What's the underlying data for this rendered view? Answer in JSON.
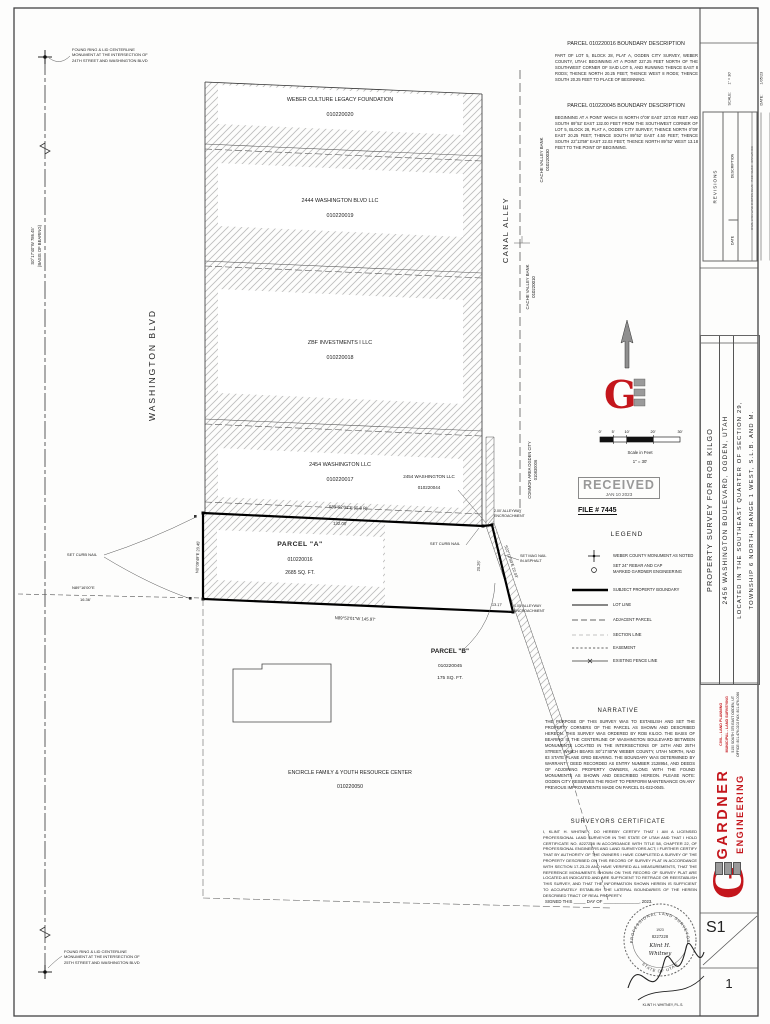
{
  "descriptions": {
    "p16_title": "PARCEL 010220016 BOUNDARY DESCRIPTION",
    "p16_body": "PART OF LOT 5, BLOCK 28, PLAT A, OGDEN CITY SURVEY, WEBER COUNTY, UTAH: BEGINNING AT A POINT 227.25 FEET NORTH OF THE SOUTHWEST CORNER OF SAID LOT 5, AND RUNNING THENCE EAST 8 RODS; THENCE NORTH 20.25 FEET; THENCE WEST 8 RODS; THENCE SOUTH 20.25 FEET TO PLACE OF BEGINNING.",
    "p45_title": "PARCEL 010220045 BOUNDARY DESCRIPTION",
    "p45_body": "BEGINNING AT A POINT WHICH IS NORTH 0°09' EAST 227.00 FEET AND SOUTH 89°52' EAST 132.00 FEET FROM THE SOUTHWEST CORNER OF LOT 5, BLOCK 28, PLAT A, OGDEN CITY SURVEY; THENCE NORTH 0°09' EAST 20.25 FEET; THENCE SOUTH 89°52' EAST 4.50 FEET; THENCE SOUTH 22°13'59\" EAST 22.03 FEET; THENCE NORTH 89°52' WEST 13.18 FEET TO THE POINT OF BEGINNING."
  },
  "map": {
    "street": "WASHINGTON BLVD",
    "alley": "CANAL ALLEY",
    "monument_top": "FOUND RING & LID CENTERLINE\nMONUMENT AT THE INTERSECTION OF\n24TH STREET AND WASHINGTON BLVD",
    "monument_bottom": "FOUND RING & LID CENTERLINE\nMONUMENT AT THE INTERSECTION OF\n25TH STREET AND WASHINGTON BLVD",
    "basis_line1": "S0°17'40\"W 786.45'",
    "basis_line2": "(BASIS OF BEARING)",
    "parcels": [
      {
        "owner": "WEBER CULTURE LEGACY FOUNDATION",
        "id": "010220020"
      },
      {
        "owner": "2444 WASHINGTON BLVD LLC",
        "id": "010220019"
      },
      {
        "owner": "ZBF INVESTMENTS I LLC",
        "id": "010220018"
      },
      {
        "owner": "2454 WASHINGTON LLC",
        "id": "010220017"
      }
    ],
    "sliver": {
      "owner": "2454 WASHINGTON LLC",
      "id": "010220044"
    },
    "cache_top": {
      "name": "CACHE VALLEY BANK",
      "id": "010220030"
    },
    "cache_bottom": {
      "name": "CACHE VALLEY BANK",
      "id": "010220010"
    },
    "common_area": {
      "name": "COMMON AREA OGDEN CITY",
      "id": "010830006"
    },
    "parcel_a": {
      "name": "PARCEL \"A\"",
      "id": "010220016",
      "area": "2685 SQ. FT."
    },
    "parcel_b": {
      "name": "PARCEL \"B\"",
      "id": "010220045",
      "area": "175 SQ. FT."
    },
    "south_parcel": {
      "owner": "ENCIRCLE FAMILY & YOUTH RESOURCE CENTER",
      "id": "010220050"
    },
    "dims": {
      "top_bearing": "S89°52'01\"E (E 8 R)",
      "top_len": "132.00'",
      "bottom": "N89°52'01\"W 145.97'",
      "left": "N0°09'49\"E 20.45'",
      "right": "20.25'",
      "diag": "S22°13'59\"E 22.03'",
      "b_bottom": "13.17'",
      "tie_bearing": "N89°16'00\"E",
      "tie_len": "16.36'"
    },
    "callouts": {
      "set_curb_nail": "SET CURB NAIL",
      "set_mag_nail": "SET MAG NAIL\nIN ASPHALT",
      "encroach_top": "2.00' ALLEYWAY\nENCROACHMENT",
      "encroach_bottom": "1.05' ALLEYWAY\nENCROACHMENT"
    }
  },
  "scalebar": {
    "ticks": [
      "0'",
      "5'",
      "10'",
      "20'",
      "30'"
    ],
    "caption": "Scale in Feet",
    "ratio": "1\" = 30'"
  },
  "received": {
    "stamp": "RECEIVED",
    "date": "JAN 10 2023",
    "file": "FILE # 7445"
  },
  "legend": {
    "title": "LEGEND",
    "items": [
      {
        "label": "WEBER COUNTY MONUMENT AS NOTED"
      },
      {
        "label": "SET 24\" REBAR AND CAP\nMARKED GARDNER ENGINEERING"
      },
      {
        "label": "SUBJECT PROPERTY BOUNDARY"
      },
      {
        "label": "LOT LINE"
      },
      {
        "label": "ADJACENT PARCEL"
      },
      {
        "label": "SECTION LINE"
      },
      {
        "label": "EASEMENT"
      },
      {
        "label": "EXISTING FENCE LINE"
      }
    ]
  },
  "narrative": {
    "title": "NARRATIVE",
    "body": "THE PURPOSE OF THIS SURVEY WAS TO ESTABLISH AND SET THE PROPERTY CORNERS OF THE PARCEL AS SHOWN AND DESCRIBED HEREON. THIS SURVEY WAS ORDERED BY ROB KILGO. THE BASIS OF BEARING IS THE CENTERLINE OF WASHINGTON BOULEVARD BETWEEN MONUMENTS LOCATED IN THE INTERSECTIONS OF 24TH AND 25TH STREET, WHICH BEARS S0°17'40\"W WEBER COUNTY, UTAH NORTH, NAD 83 STATE PLANE GRID BEARING. THE BOUNDARY WAS DETERMINED BY WARRANTY DEED RECORDED AS ENTRY NUMBER 2128954, AND DEEDS OF ADJOINING PROPERTY OWNERS, ALONG WITH THE FOUND MONUMENTS AS SHOWN AND DESCRIBED HEREON. PLEASE NOTE: OGDEN CITY RESERVES THE RIGHT TO PERFORM MAINTENANCE ON ANY PREVIOUS IMPROVEMENTS MADE ON PARCEL 01-022-0045."
  },
  "certificate": {
    "title": "SURVEYORS CERTIFICATE",
    "body": "I, KLINT H. WHITNEY, DO HEREBY CERTIFY THAT I AM A LICENSED PROFESSIONAL LAND SURVEYOR IN THE STATE OF UTAH AND THAT I HOLD CERTIFICATE NO. 8227228 IN ACCORDANCE WITH TITLE 58, CHAPTER 22, OF PROFESSIONAL ENGINEERS AND LAND SURVEYORS ACT; I FURTHER CERTIFY THAT BY AUTHORITY OF THE OWNERS I HAVE COMPLETED A SURVEY OF THE PROPERTY DESCRIBED ON THIS RECORD OF SURVEY PLAT IN ACCORDANCE WITH SECTION 17-23-20 AND HAVE VERIFIED ALL MEASUREMENTS, THAT THE REFERENCE MONUMENTS SHOWN ON THIS RECORD OF SURVEY PLAT ARE LOCATED AS INDICATED AND ARE SUFFICIENT TO RETRACE OR REESTABLISH THIS SURVEY, AND THAT THE INFORMATION SHOWN HEREIN IS SUFFICIENT TO ACCURATELY ESTABLISH THE LATERAL BOUNDARIES OF THE HEREIN DESCRIBED TRACT OF REAL PROPERTY.",
    "signed": "SIGNED THIS _____ DAY OF _______________, 2023.",
    "signature_name": "KLINT H. WHITNEY, P.L.S.",
    "seal_year": "1923",
    "seal_number": "8227228",
    "seal_name1": "Klint H.",
    "seal_name2": "Whitney",
    "seal_arc_top": "PROFESSIONAL LAND SURVEYOR",
    "seal_arc_bottom": "STATE OF UTAH"
  },
  "titleblock": {
    "fields": [
      {
        "label": "SCALE:",
        "value": "1\" = 30'"
      },
      {
        "label": "DATE:",
        "value": "1/05/23"
      },
      {
        "label": "DESIGN:",
        "value": "-----"
      },
      {
        "label": "DRAWN:",
        "value": "JTH"
      },
      {
        "label": "CHECKED:",
        "value": "KHW"
      }
    ],
    "revisions": {
      "title": "REVISIONS",
      "col_date": "DATE",
      "col_desc": "DESCRIPTION"
    },
    "dwg": "DWG: 2456 WASHINGTON BLVD - ROB KILGO - DRAWINGS",
    "title_lines": [
      "PROPERTY SURVEY FOR ROB KILGO",
      "2456 WASHINGTON BOULEVARD, OGDEN, UTAH",
      "LOCATED IN THE SOUTHEAST QUARTER OF SECTION 29,",
      "TOWNSHIP 6 NORTH, RANGE 1 WEST, S.L.B. AND M."
    ],
    "logo": {
      "g": "G",
      "name1": "GARDNER",
      "name2": "ENGINEERING",
      "tag1": "CIVIL - LAND PLANNING",
      "tag2": "MUNICIPAL - LAND SURVEYING",
      "addr1": "5150 SOUTH 375 EAST OGDEN, UT",
      "addr2": "OFFICE: 801.476.0202 FAX: 801.476.0066"
    },
    "sheet_code": "S1",
    "sheet_number": "1"
  },
  "colors": {
    "accent_red": "#c4161c",
    "ink": "#222222",
    "hatch": "#bcbcbc"
  }
}
